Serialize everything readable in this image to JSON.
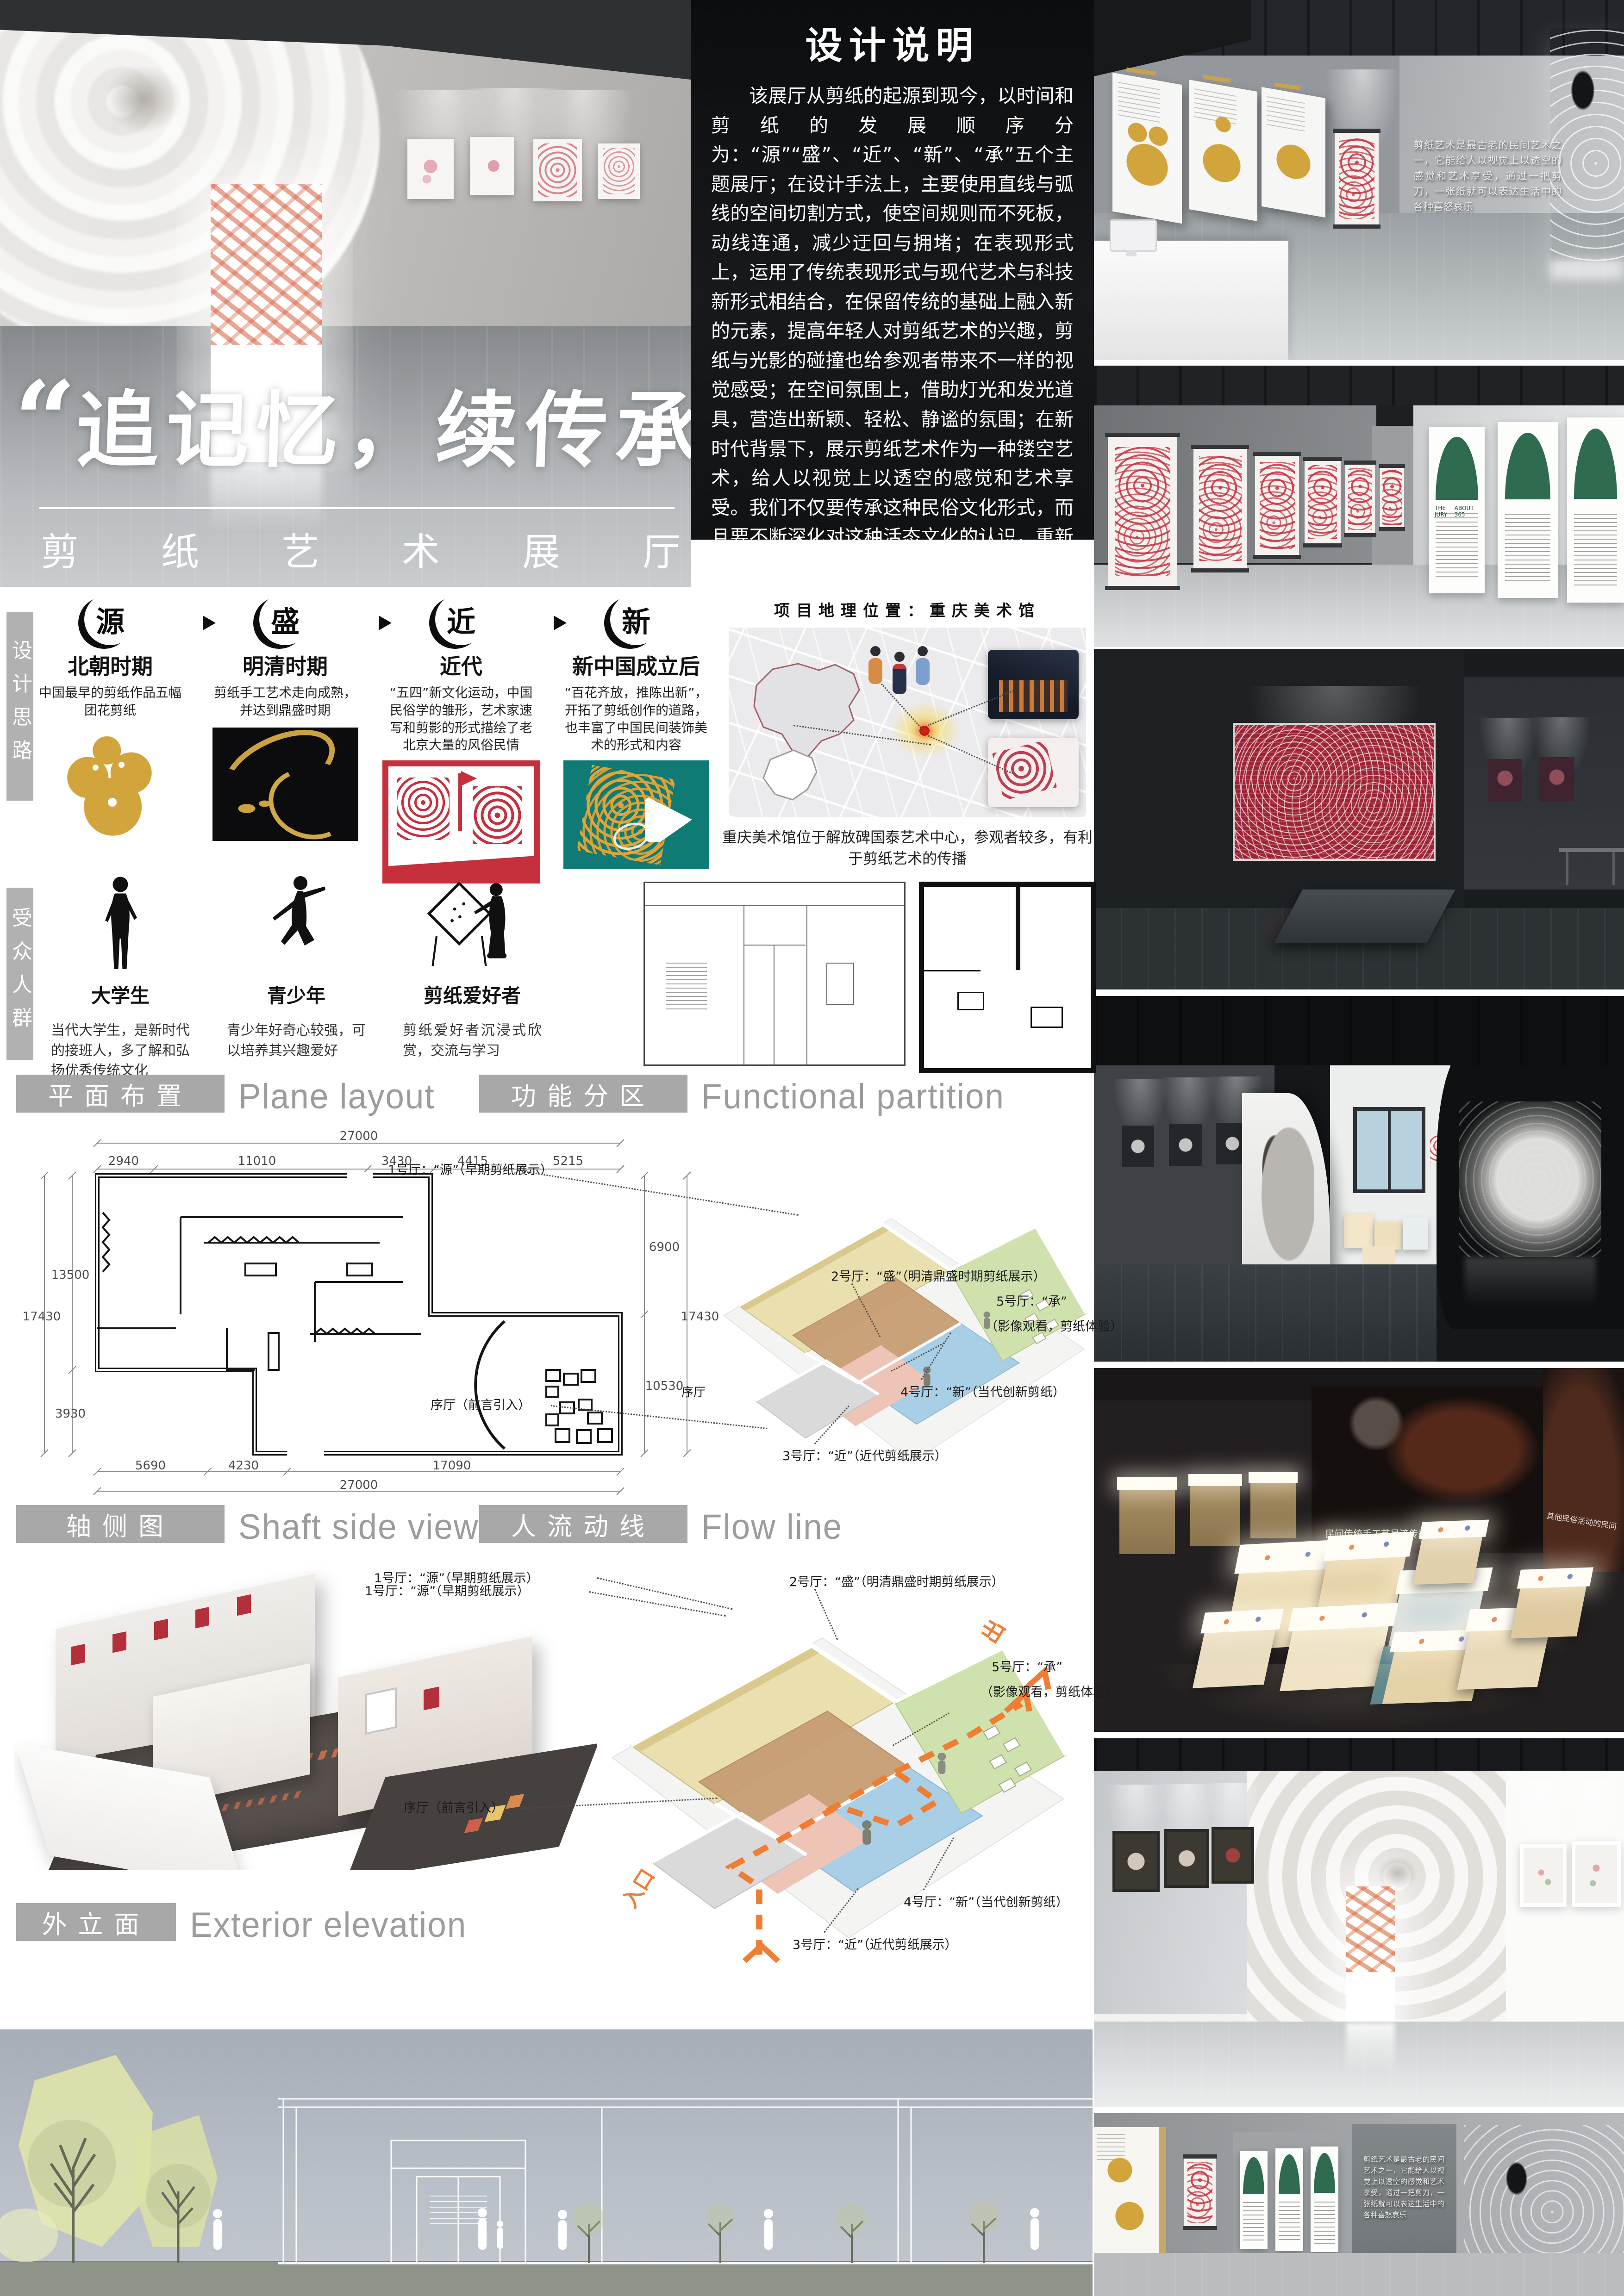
{
  "hero": {
    "quote_open": "“",
    "quote": "追记忆，续传承",
    "quote_close": "”",
    "subtitle": "剪纸艺术展厅"
  },
  "design_note": {
    "title": "设计说明",
    "body": "该展厅从剪纸的起源到现今，以时间和剪纸的发展顺序分为：“源”“盛”、“近”、“新”、“承”五个主题展厅；在设计手法上，主要使用直线与弧线的空间切割方式，使空间规则而不死板，动线连通，减少迂回与拥堵；在表现形式上，运用了传统表现形式与现代艺术与科技新形式相结合，在保留传统的基础上融入新的元素，提高年轻人对剪纸艺术的兴趣，剪纸与光影的碰撞也给参观者带来不一样的视觉感受；在空间氛围上，借助灯光和发光道具，营造出新颖、轻松、静谧的氛围；在新时代背景下，展示剪纸艺术作为一种镂空艺术，给人以视觉上以透空的感觉和艺术享受。我们不仅要传承这种民俗文化形式，而且要不断深化对这种活态文化的认识，重新激发民俗艺术的生命力，让民族的精神血液继续鲜活的流淌在中华大地"
  },
  "timeline": {
    "label": "设计思路",
    "items": [
      {
        "badge": "源",
        "title": "北朝时期",
        "desc": "中国最早的剪纸作品五幅团花剪纸"
      },
      {
        "badge": "盛",
        "title": "明清时期",
        "desc": "剪纸手工艺术走向成熟，并达到鼎盛时期"
      },
      {
        "badge": "近",
        "title": "近代",
        "desc": "“五四”新文化运动，中国民俗学的雏形，艺术家速写和剪影的形式描绘了老北京大量的风俗民情"
      },
      {
        "badge": "新",
        "title": "新中国成立后",
        "desc": "“百花齐放，推陈出新”，开拓了剪纸创作的道路，也丰富了中国民间装饰美术的形式和内容"
      }
    ]
  },
  "location": {
    "title": "项目地理位置：重庆美术馆",
    "caption": "重庆美术馆位于解放碑国泰艺术中心，参观者较多，有利于剪纸艺术的传播"
  },
  "audience": {
    "label": "受众人群",
    "items": [
      {
        "title": "大学生",
        "desc": "当代大学生，是新时代的接班人，多了解和弘扬优秀传统文化"
      },
      {
        "title": "青少年",
        "desc": "青少年好奇心较强，可以培养其兴趣爱好"
      },
      {
        "title": "剪纸爱好者",
        "desc": "剪纸爱好者沉浸式欣赏，交流与学习"
      }
    ]
  },
  "sections": {
    "plane": {
      "zh": "平面布置",
      "en": "Plane layout"
    },
    "partition": {
      "zh": "功能分区",
      "en": "Functional partition"
    },
    "shaft": {
      "zh": "轴侧图",
      "en": "Shaft side view"
    },
    "flow": {
      "zh": "人流动线",
      "en": "Flow line"
    },
    "exterior": {
      "zh": "外立面",
      "en": "Exterior elevation"
    }
  },
  "plan": {
    "dim_total_top": "27000",
    "seg_top": [
      "2940",
      "11010",
      "3430",
      "4415",
      "5215"
    ],
    "left_upper": "13500",
    "left_lower": "3930",
    "left_outer": "17430",
    "right_upper": "6900",
    "right_lower": "10530",
    "right_outer": "17430",
    "bottom_segs": [
      "5690",
      "4230",
      "17090"
    ],
    "dim_total_bottom": "27000",
    "lobby_short": "序厅"
  },
  "halls": {
    "h1": "1号厅：“源”（早期剪纸展示）",
    "h2": "2号厅：“盛”（明清鼎盛时期剪纸展示）",
    "h3": "3号厅：“近”（近代剪纸展示）",
    "h4": "4号厅：“新”（当代创新剪纸）",
    "h5a": "5号厅：“承”",
    "h5b": "（影像观看，剪纸体验）",
    "lobby": "序厅（前言引入）"
  },
  "flow_marks": {
    "entrance": "入口",
    "exit": "出"
  },
  "renders": {
    "wall_text": "剪纸艺术是最古老的民间艺术之一，它能给人以视觉上以透空的感觉和艺术享受，通过一把剪刀，一张纸就可以表达生活中的各种喜怒哀乐",
    "projection_caption": "民间传统手工艺是流传最久的",
    "projection_caption_side": "其他民俗活动的民间",
    "poster_caption_a": "THE JURY",
    "poster_caption_b": "ABOUT 365"
  }
}
